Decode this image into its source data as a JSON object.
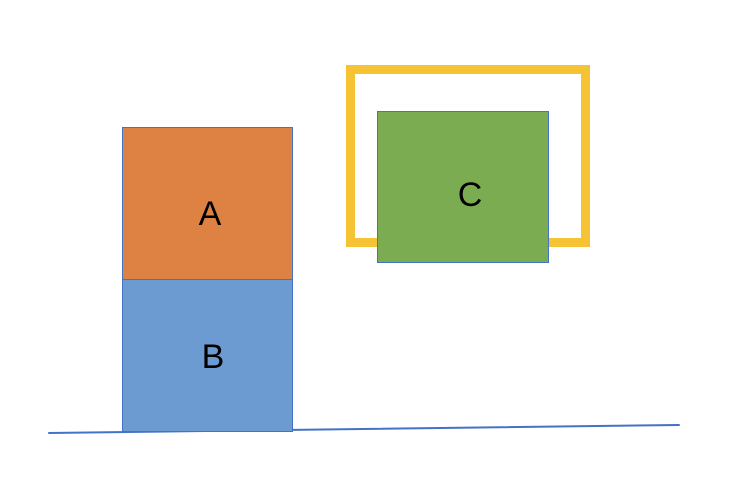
{
  "canvas": {
    "width": 730,
    "height": 484,
    "background": "#FFFFFF"
  },
  "shapes": {
    "box_a": {
      "label": "A",
      "fill": "#DE8244",
      "stroke": "#4472C4"
    },
    "box_b": {
      "label": "B",
      "fill": "#6B9BD1",
      "stroke": "#4472C4"
    },
    "box_c": {
      "label": "C",
      "fill": "#7CAC52",
      "stroke": "#4472C4"
    },
    "frame": {
      "stroke": "#F5C334"
    },
    "ground_line": {
      "stroke": "#4472C4"
    }
  },
  "text_color": "#000000"
}
